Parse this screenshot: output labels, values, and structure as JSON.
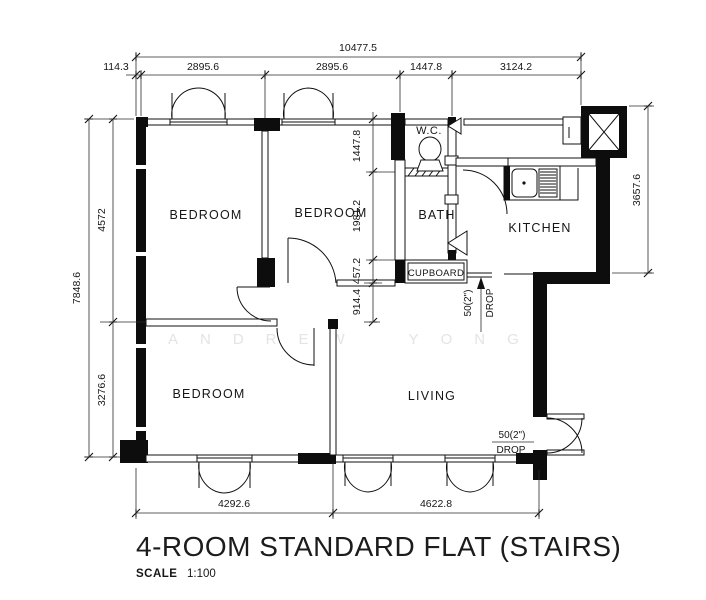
{
  "title": {
    "text": "4-ROOM STANDARD FLAT (STAIRS)",
    "scale_label": "SCALE",
    "scale_value": "1:100"
  },
  "watermark": {
    "text": "ANDREW YONG"
  },
  "rooms": {
    "bedroom_1": "BEDROOM",
    "bedroom_2": "BEDROOM",
    "bedroom_3": "BEDROOM",
    "living": "LIVING",
    "kitchen": "KITCHEN",
    "bath": "BATH",
    "wc": "W.C.",
    "cupboard": "CUPBOARD"
  },
  "drops": {
    "kitchen": {
      "value": "50(2\")",
      "word": "DROP"
    },
    "entrance": {
      "value": "50(2\")",
      "word": "DROP"
    }
  },
  "dims": {
    "top_overall": "10477.5",
    "top": [
      "114.3",
      "2895.6",
      "2895.6",
      "1447.8",
      "3124.2"
    ],
    "left_overall": "7848.6",
    "left": [
      "4572",
      "3276.6"
    ],
    "right": "3657.6",
    "middle": [
      "1447.8",
      "1981.2",
      "457.2",
      "914.4"
    ],
    "bottom": [
      "4292.6",
      "4622.8"
    ]
  }
}
